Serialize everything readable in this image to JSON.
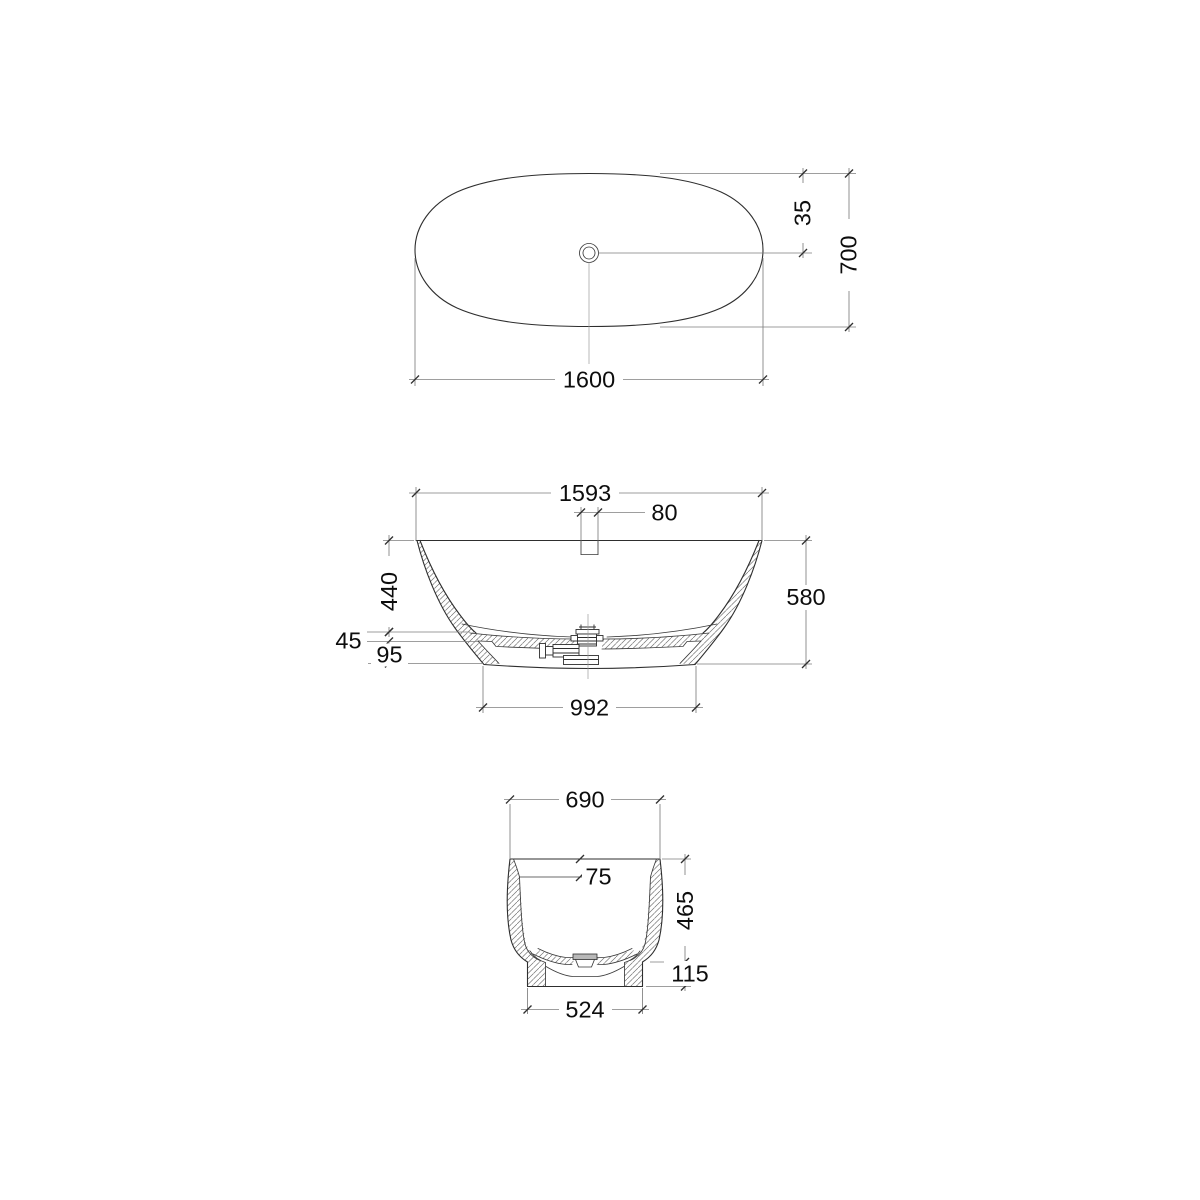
{
  "drawing": {
    "title": "bathtub-technical-drawing",
    "colors": {
      "object_line": "#2e2e2e",
      "dimension_line": "#7e7e7e",
      "text": "#0d0d0d",
      "drain_fill": "#b8b8b8",
      "background": "#ffffff"
    },
    "views": {
      "plan": {
        "dims": {
          "overall_length": "1600",
          "overall_width": "700",
          "drain_offset": "35"
        }
      },
      "front_section": {
        "dims": {
          "rim_length": "1593",
          "overflow_width": "80",
          "rim_to_floor_depth": "440",
          "floor_thickness": "45",
          "base_height": "95",
          "overall_height": "580",
          "base_length": "992"
        }
      },
      "side_section": {
        "dims": {
          "rim_width": "690",
          "rim_edge_height": "75",
          "inner_depth": "465",
          "base_height": "115",
          "base_width": "524"
        }
      }
    }
  }
}
